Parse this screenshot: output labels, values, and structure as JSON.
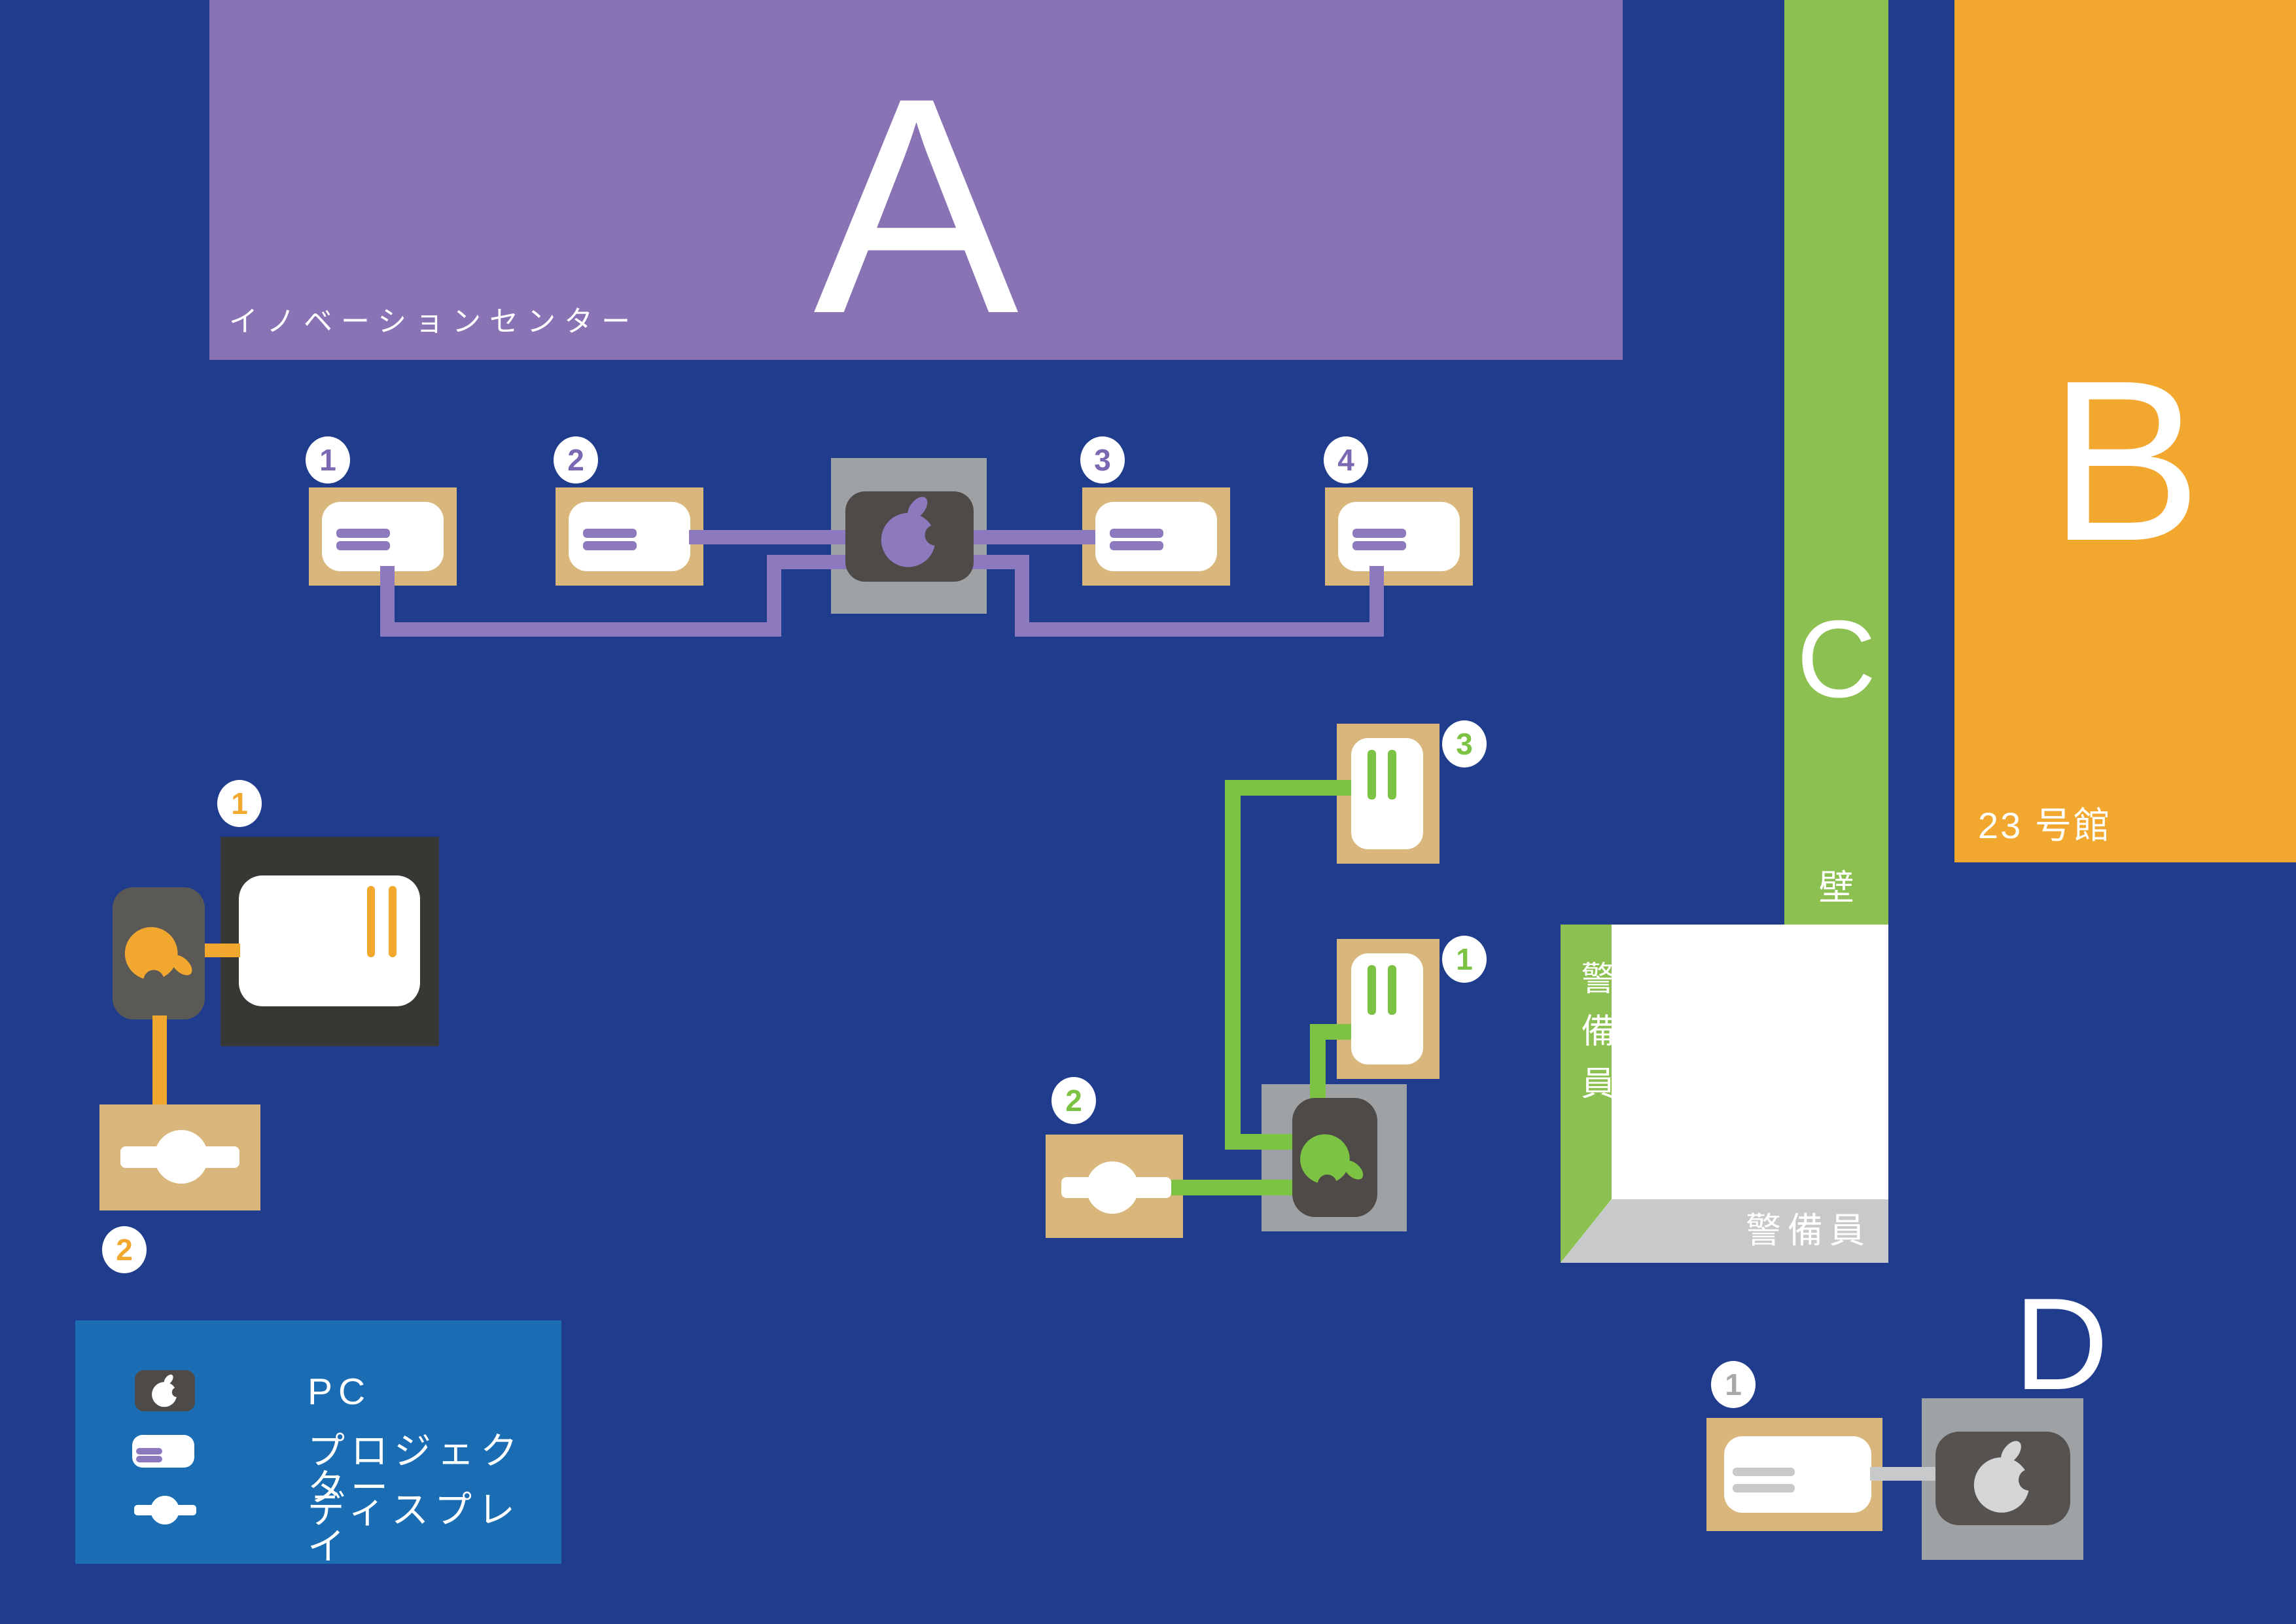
{
  "colors": {
    "navy": "#203D8D",
    "legend-blue": "#1A6CB3",
    "purple-bldg": "#8973B4",
    "purple-line": "#8C79BE",
    "purple-num": "#7B68B2",
    "orange": "#F2A72E",
    "green": "#8CC152",
    "green-line": "#7CC243",
    "tan": "#D9B77C",
    "gray-outer": "#9FA2A5",
    "dark-gray": "#4E4A47",
    "tv-dark": "#393734",
    "mid-gray": "#5B5955",
    "d-dark": "#555250",
    "light-gray": "#C7C9CB",
    "silver": "#D3D5D7",
    "room-gray": "#C8C9CB",
    "badge-gray": "#A9A9A9"
  },
  "buildings": {
    "a": {
      "letter": "A",
      "name": "イノベーションセンター"
    },
    "b": {
      "letter": "B",
      "name": "23 号館"
    },
    "c": {
      "letter": "C"
    },
    "d": {
      "letter": "D"
    }
  },
  "labels": {
    "wall": "壁",
    "guard_left": "警備員",
    "guard_bottom": "警備員"
  },
  "legend": {
    "pc": "PC",
    "projector": "プロジェクター",
    "display": "ディスプレイ"
  },
  "badges": {
    "purple": [
      "1",
      "2",
      "3",
      "4"
    ],
    "orange": {
      "monitor": "1",
      "display": "2"
    },
    "green": {
      "projector_top": "3",
      "projector_mid": "1",
      "display": "2"
    },
    "d": {
      "projector": "1"
    }
  }
}
